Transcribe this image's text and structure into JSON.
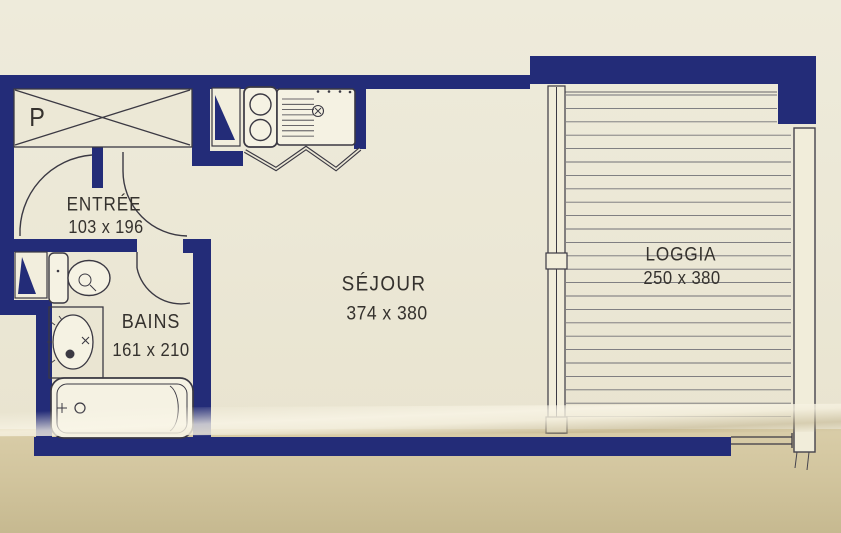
{
  "document": {
    "type": "floor-plan",
    "description": "Studio apartment blueprint, dark blue walls printed on cream folded paper"
  },
  "colors": {
    "wall": "#232c78",
    "paper": "#ebe7d5",
    "paper_lower_fold": "#d2c59e",
    "drawing_line": "#3b3943",
    "fixture_fill": "#f5f2e3",
    "text": "#35322e"
  },
  "rooms": [
    {
      "id": "placard",
      "label": "P"
    },
    {
      "id": "entree",
      "name": "ENTRÉE",
      "dims": "103 x 196"
    },
    {
      "id": "bains",
      "name": "BAINS",
      "dims": "161 x 210"
    },
    {
      "id": "sejour",
      "name": "SÉJOUR",
      "dims": "374 x 380"
    },
    {
      "id": "loggia",
      "name": "LOGGIA",
      "dims": "250 x 380"
    }
  ],
  "fixtures": [
    "wardrobe-crossed-box",
    "vent-duct-triangle-kitchen",
    "stove-two-burners",
    "kitchen-sink-counter",
    "folding-accordion-door",
    "entry-door-swing-arcs",
    "vent-duct-triangle-bath",
    "toilet",
    "washbasin",
    "bathtub",
    "bath-door-swing",
    "window-wall-loggia",
    "loggia-deck-boards",
    "loggia-railing"
  ]
}
